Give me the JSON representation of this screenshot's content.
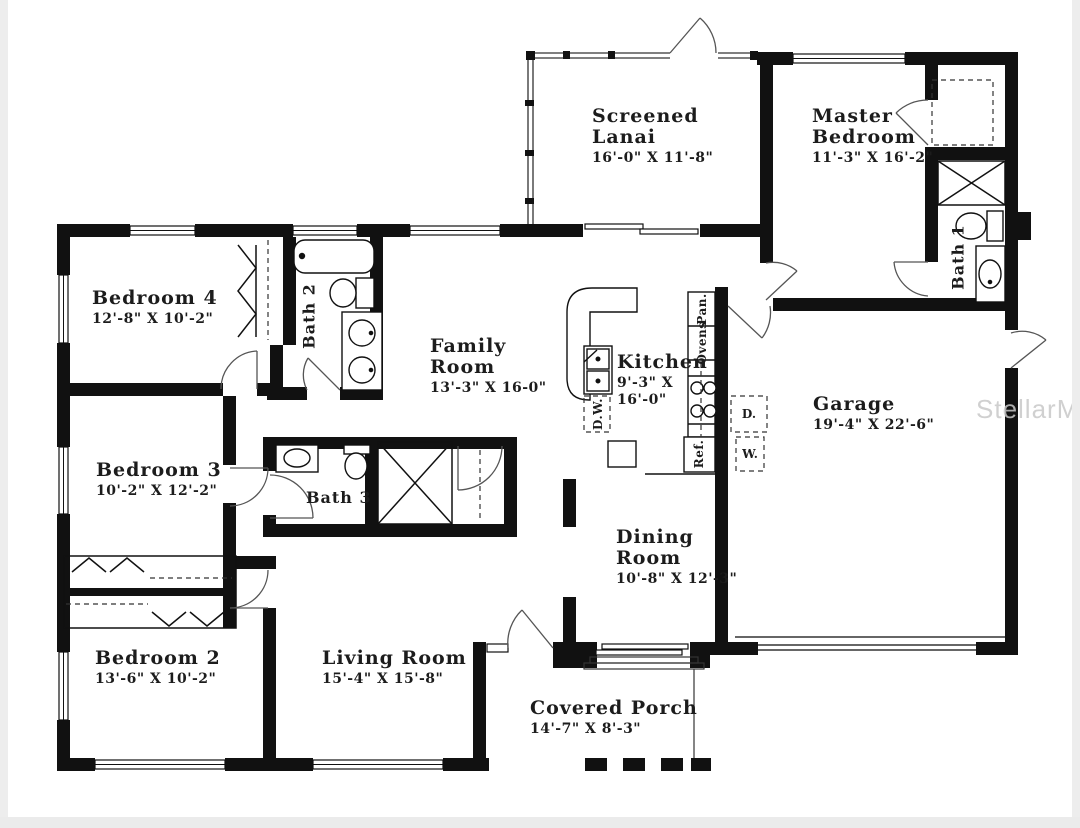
{
  "watermark": "StellarMLS",
  "rooms": {
    "screened_lanai": {
      "line1": "Screened",
      "line2": "Lanai",
      "dims": "16'-0\" X 11'-8\""
    },
    "master_bedroom": {
      "line1": "Master",
      "line2": "Bedroom",
      "dims": "11'-3\" X 16'-2\""
    },
    "bedroom_4": {
      "line1": "Bedroom 4",
      "dims": "12'-8\" X 10'-2\""
    },
    "family_room": {
      "line1": "Family",
      "line2": "Room",
      "dims": "13'-3\" X 16-0\""
    },
    "kitchen": {
      "line1": "Kitchen",
      "dims": "9'-3\" X",
      "dims2": "16'-0\""
    },
    "garage": {
      "line1": "Garage",
      "dims": "19'-4\" X 22'-6\""
    },
    "bedroom_3": {
      "line1": "Bedroom 3",
      "dims": "10'-2\" X 12'-2\""
    },
    "dining_room": {
      "line1": "Dining",
      "line2": "Room",
      "dims": "10'-8\" X 12'-3\""
    },
    "bedroom_2": {
      "line1": "Bedroom 2",
      "dims": "13'-6\" X 10'-2\""
    },
    "living_room": {
      "line1": "Living Room",
      "dims": "15'-4\" X 15'-8\""
    },
    "covered_porch": {
      "line1": "Covered Porch",
      "dims": "14'-7\" X 8'-3\""
    }
  },
  "bath_labels": {
    "bath_1": "Bath 1",
    "bath_2": "Bath 2",
    "bath_3": "Bath 3"
  },
  "appliance_labels": {
    "pantry": "Pan.",
    "ovens": "Ovens",
    "refrigerator": "Ref.",
    "dishwasher": "D.W.",
    "dryer": "D.",
    "washer": "W."
  },
  "colors": {
    "wall": "#111111",
    "text": "#1c1c1c",
    "watermark": "#c8c8c8",
    "page_edge": "#ededed"
  }
}
